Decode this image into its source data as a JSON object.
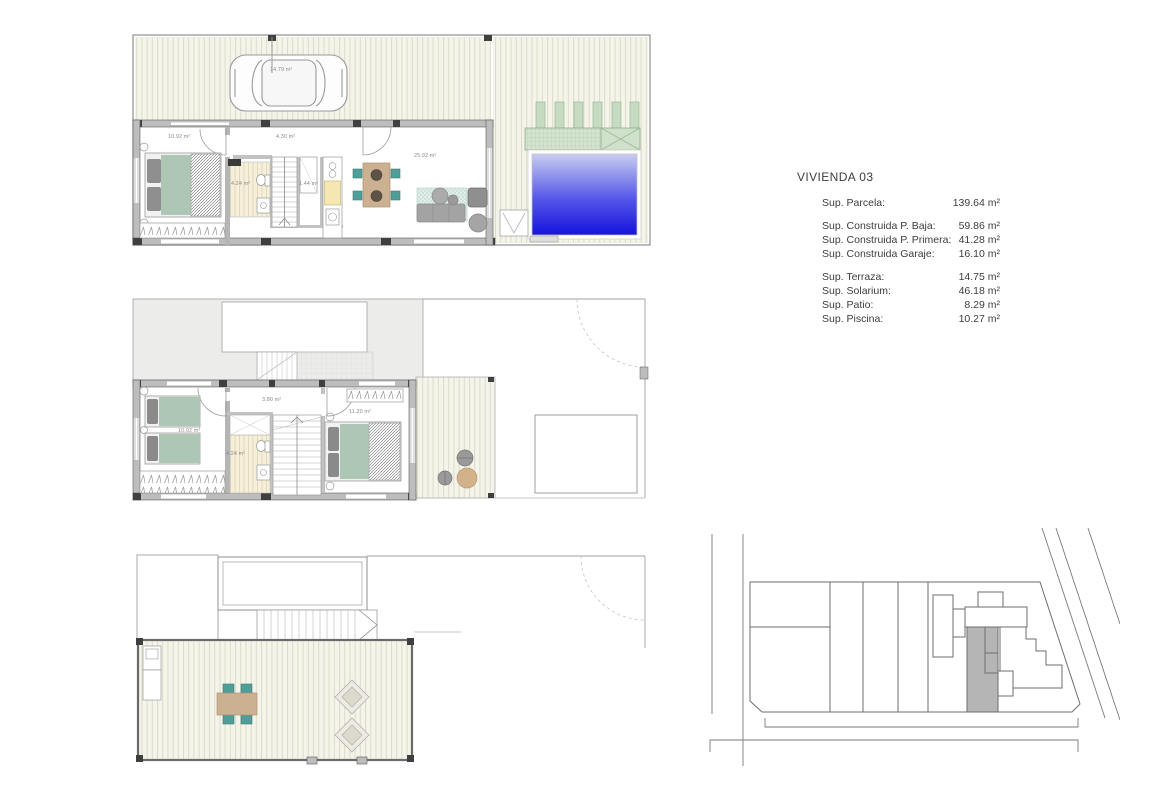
{
  "title": "VIVIENDA 03",
  "areas": {
    "rows": [
      {
        "label": "Sup. Parcela:",
        "value": "139.64 m²"
      },
      {
        "label": "Sup. Construida P. Baja:",
        "value": "59.86 m²"
      },
      {
        "label": "Sup. Construida P. Primera:",
        "value": "41.28 m²"
      },
      {
        "label": "Sup. Construida Garaje:",
        "value": "16.10 m²"
      },
      {
        "label": "Sup. Terraza:",
        "value": "14.75 m²"
      },
      {
        "label": "Sup. Solarium:",
        "value": "46.18 m²"
      },
      {
        "label": "Sup. Patio:",
        "value": "8.29 m²"
      },
      {
        "label": "Sup. Piscina:",
        "value": "10.27 m²"
      }
    ]
  },
  "plans": {
    "ground_floor": {
      "labels": {
        "garage": "14.79 m²",
        "bedroom": "10.92 m²",
        "hall": "4.30 m²",
        "bathroom": "4.24 m²",
        "closet": "1.44 m²",
        "living": "25.92 m²"
      }
    },
    "first_floor": {
      "labels": {
        "hall": "3.80 m²",
        "bedroom_left": "10.92 m²",
        "bathroom": "4.24 m²",
        "bedroom_right": "11.20 m²"
      }
    }
  },
  "colors": {
    "pool_top": "#c9cdf0",
    "pool_mid": "#5558e8",
    "pool_bottom": "#1612dd",
    "bed_green": "#aec6b4",
    "chair_teal": "#4f9e98",
    "table_tan": "#cbb191",
    "planter_green": "#cfe0cb",
    "site_highlight": "#b5b5b5",
    "deck_cream": "#f5f4ea",
    "wall_gray": "#bdbdbd",
    "wall_dark": "#3f3f3f"
  }
}
